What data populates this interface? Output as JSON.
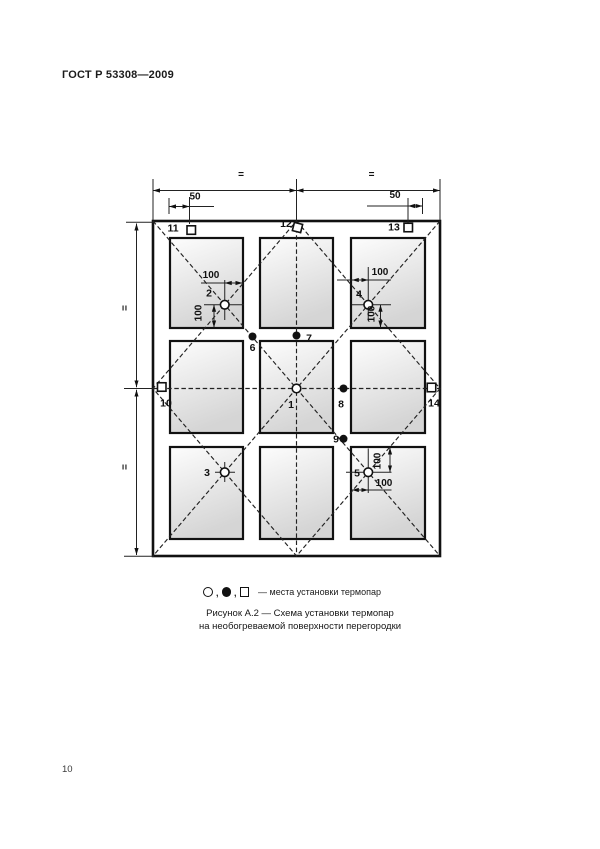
{
  "page": {
    "standard_code": "ГОСТ Р 53308—2009",
    "page_number": "10"
  },
  "figure": {
    "caption_line1": "Рисунок А.2 — Схема установки термопар",
    "caption_line2": "на необогреваемой поверхности перегородки",
    "legend": {
      "separator": ",",
      "description": "— места установки термопар"
    },
    "dims": {
      "equal": "=",
      "d50": "50",
      "d100": "100"
    },
    "points": {
      "p1": "1",
      "p2": "2",
      "p3": "3",
      "p4": "4",
      "p5": "5",
      "p6": "6",
      "p7": "7",
      "p8": "8",
      "p9": "9",
      "p10": "10",
      "p11": "11",
      "p12": "12",
      "p13": "13",
      "p14": "14"
    }
  }
}
